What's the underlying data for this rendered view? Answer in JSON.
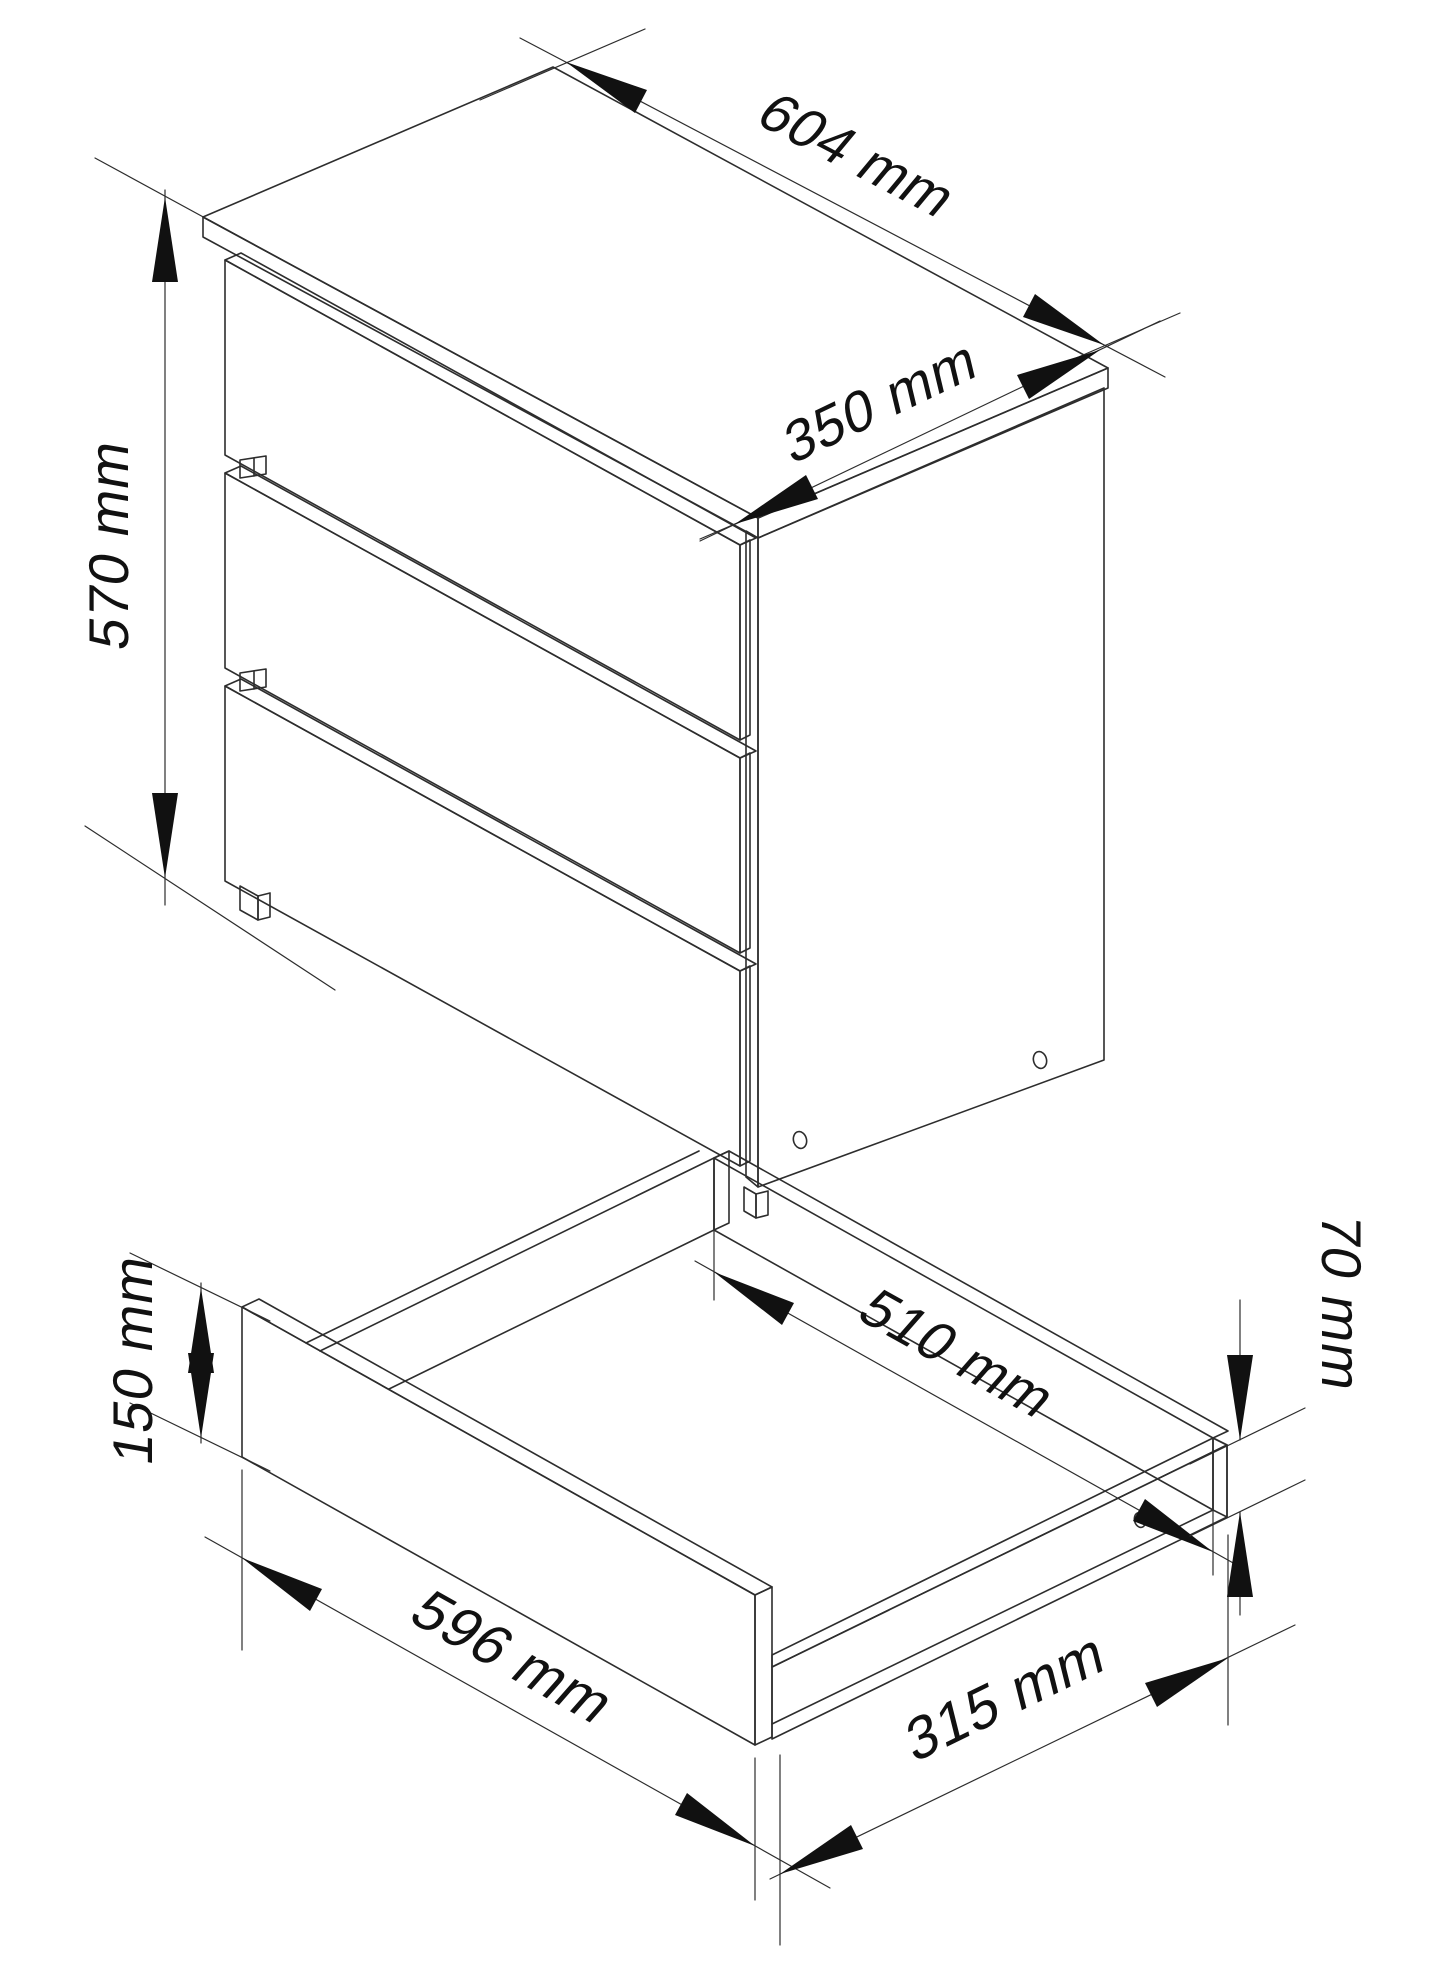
{
  "diagram": {
    "type": "furniture-technical-drawing",
    "units": "mm",
    "cabinet": {
      "name": "chest-of-drawers-3-drawers",
      "width": {
        "value": 604,
        "label": "604 mm"
      },
      "depth": {
        "value": 350,
        "label": "350 mm"
      },
      "height": {
        "value": 570,
        "label": "570 mm"
      }
    },
    "drawer": {
      "name": "open-drawer-box",
      "front_height": {
        "value": 150,
        "label": "150 mm"
      },
      "inner_width": {
        "value": 510,
        "label": "510 mm"
      },
      "front_width": {
        "value": 596,
        "label": "596 mm"
      },
      "inner_depth": {
        "value": 315,
        "label": "315 mm"
      },
      "side_height": {
        "value": 70,
        "label": "70 mm"
      }
    }
  }
}
